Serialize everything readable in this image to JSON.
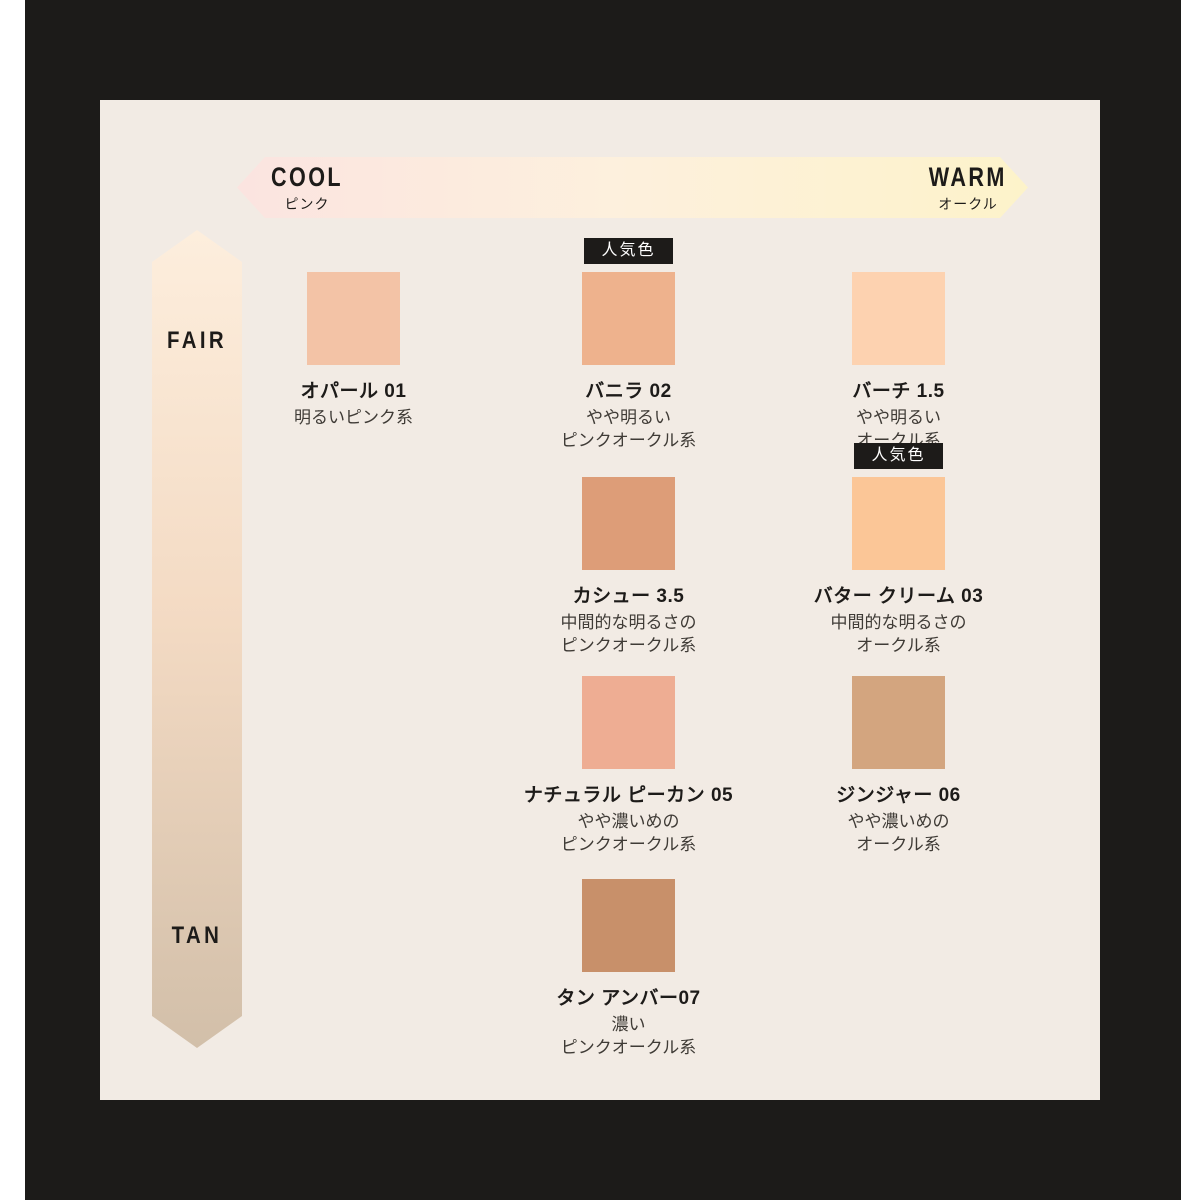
{
  "chart": {
    "horizontal_axis": {
      "left_label": "COOL",
      "left_sublabel": "ピンク",
      "right_label": "WARM",
      "right_sublabel": "オークル",
      "gradient": [
        "#fbe4e0",
        "#fdf0dd",
        "#fdf3ca"
      ]
    },
    "vertical_axis": {
      "top_label": "FAIR",
      "bottom_label": "TAN",
      "gradient": [
        "#fdeedd",
        "#f3dac3",
        "#d2bfa9"
      ]
    },
    "popular_badge_label": "人気色",
    "shades": [
      {
        "name": "オパール 01",
        "desc_lines": [
          "明るいピンク系"
        ],
        "color": "#f3c3a6",
        "popular": false,
        "row": 1,
        "col": 1
      },
      {
        "name": "バニラ 02",
        "desc_lines": [
          "やや明るい",
          "ピンクオークル系"
        ],
        "color": "#eeb28d",
        "popular": true,
        "row": 1,
        "col": 2
      },
      {
        "name": "バーチ 1.5",
        "desc_lines": [
          "やや明るい",
          "オークル系"
        ],
        "color": "#fdd2b0",
        "popular": false,
        "row": 1,
        "col": 3
      },
      {
        "name": "カシュー 3.5",
        "desc_lines": [
          "中間的な明るさの",
          "ピンクオークル系"
        ],
        "color": "#dd9d78",
        "popular": false,
        "row": 2,
        "col": 2
      },
      {
        "name": "バター クリーム 03",
        "desc_lines": [
          "中間的な明るさの",
          "オークル系"
        ],
        "color": "#fbc697",
        "popular": true,
        "row": 2,
        "col": 3
      },
      {
        "name": "ナチュラル ピーカン 05",
        "desc_lines": [
          "やや濃いめの",
          "ピンクオークル系"
        ],
        "color": "#eead93",
        "popular": false,
        "row": 3,
        "col": 2
      },
      {
        "name": "ジンジャー 06",
        "desc_lines": [
          "やや濃いめの",
          "オークル系"
        ],
        "color": "#d3a57f",
        "popular": false,
        "row": 3,
        "col": 3
      },
      {
        "name": "タン アンバー07",
        "desc_lines": [
          "濃い",
          "ピンクオークル系"
        ],
        "color": "#c8906a",
        "popular": false,
        "row": 4,
        "col": 2
      }
    ],
    "colors": {
      "frame": "#1c1b19",
      "panel_bg": "#f2ebe4",
      "text_dark": "#1d1b19",
      "text_desc": "#3f3b36",
      "badge_bg": "#1d1b19",
      "badge_text": "#ffffff"
    }
  }
}
